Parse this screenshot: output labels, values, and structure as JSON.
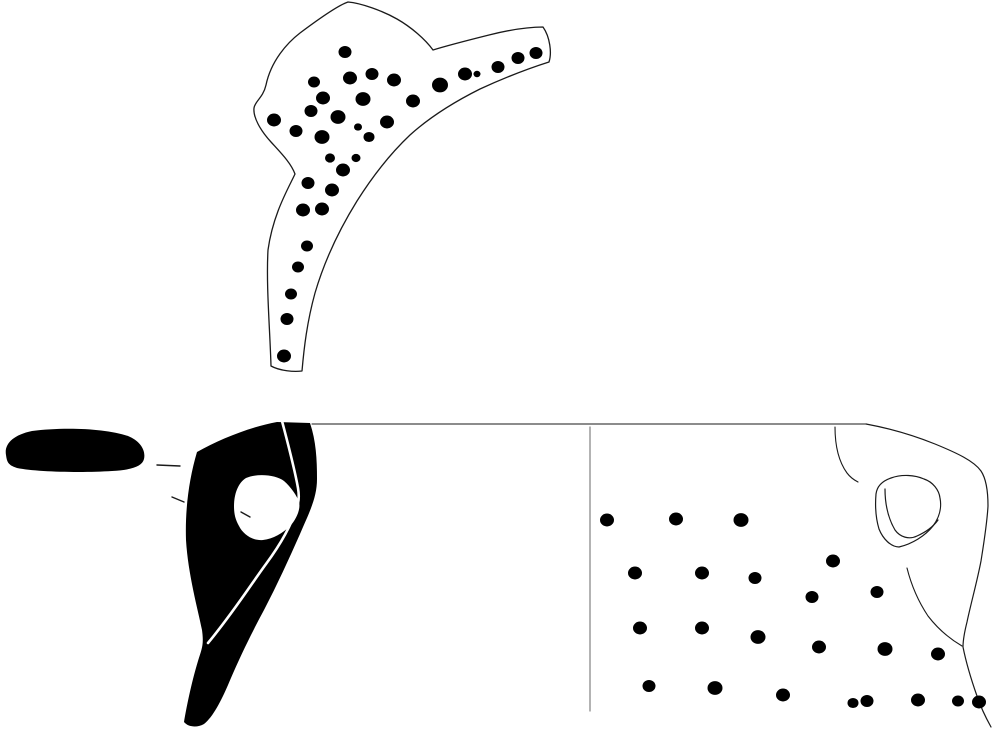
{
  "canvas": {
    "width": 995,
    "height": 730,
    "background_color": "#ffffff",
    "ink_color": "#000000",
    "outline_color": "#1a1a1a",
    "divider_color": "#8a8a8a"
  },
  "figures": {
    "top_sherd": {
      "elements": [
        {
          "kind": "path",
          "name": "top-sherd-outline",
          "d": "M348,2 C336,6 312,24 300,33 C287,43 271,61 266,85 C263,98 255,101 254,108 C253,117 260,130 271,142 C281,153 291,163 295,174 C288,189 273,214 268,250 C266,285 270,330 271,366 C280,371 294,372 302,371 C304,348 307,322 315,293 C325,259 339,230 357,201 C374,174 391,153 410,135 C431,116 456,101 480,89 C504,78 530,68 549,62 C552,53 550,37 543,27 C529,27 509,30 489,35 C469,40 449,45 433,50 C425,39 411,27 397,19 C383,11 361,3 348,2 Z",
          "fill": "#ffffff",
          "stroke": "#1a1a1a",
          "stroke_width": 1.3
        },
        {
          "kind": "dots",
          "name": "puncture-dot",
          "fill": "#000000",
          "points": [
            [
              345,
              52,
              6.5
            ],
            [
              314,
              82,
              6
            ],
            [
              350,
              78,
              7
            ],
            [
              372,
              74,
              6.5
            ],
            [
              394,
              80,
              7
            ],
            [
              440,
              85,
              8
            ],
            [
              465,
              74,
              7
            ],
            [
              477,
              74,
              3.5
            ],
            [
              498,
              67,
              6.5
            ],
            [
              518,
              58,
              6.5
            ],
            [
              536,
              53,
              6.5
            ],
            [
              323,
              98,
              7
            ],
            [
              363,
              99,
              7.5
            ],
            [
              413,
              101,
              7
            ],
            [
              274,
              120,
              7
            ],
            [
              311,
              111,
              6.5
            ],
            [
              338,
              117,
              7.5
            ],
            [
              387,
              122,
              7
            ],
            [
              296,
              131,
              6.5
            ],
            [
              358,
              127,
              4
            ],
            [
              322,
              137,
              7.5
            ],
            [
              369,
              137,
              5.5
            ],
            [
              330,
              158,
              5
            ],
            [
              356,
              158,
              4.5
            ],
            [
              343,
              170,
              7
            ],
            [
              308,
              183,
              6.5
            ],
            [
              332,
              190,
              7
            ],
            [
              303,
              210,
              7
            ],
            [
              322,
              209,
              7
            ],
            [
              307,
              246,
              6
            ],
            [
              298,
              267,
              6
            ],
            [
              291,
              294,
              6
            ],
            [
              287,
              319,
              6.5
            ],
            [
              284,
              356,
              7
            ]
          ]
        }
      ]
    },
    "handle_plan": {
      "elements": [
        {
          "kind": "path",
          "name": "handle-plan-silhouette",
          "d": "M6,455 C4,444 13,435 32,431 C62,427 104,428 128,436 C140,441 146,450 144,459 C142,467 130,470 112,471 C82,473 36,472 17,468 C8,465 7,462 6,455 Z",
          "fill": "#000000",
          "stroke": "none",
          "stroke_width": 0
        },
        {
          "kind": "line",
          "name": "measure-tick",
          "x1": 157,
          "y1": 465,
          "x2": 180,
          "y2": 466,
          "stroke": "#1a1a1a",
          "stroke_width": 1.4
        },
        {
          "kind": "line",
          "name": "measure-tick",
          "x1": 172,
          "y1": 497,
          "x2": 184,
          "y2": 502,
          "stroke": "#1a1a1a",
          "stroke_width": 1.4
        }
      ]
    },
    "handle_section": {
      "elements": [
        {
          "kind": "path",
          "name": "handle-section-silhouette",
          "d": "M197,452 C220,439 250,427 277,422 L310,423 C316,441 317,459 317,479 C317,498 309,513 300,534 C289,559 277,585 264,610 C251,634 238,661 228,685 C221,701 213,717 204,724 C197,728 188,727 184,722 C186,710 191,684 198,661 C202,648 204,645 202,630 C198,610 188,574 186,540 C185,509 189,479 197,452 Z",
          "fill": "#000000",
          "stroke": "none",
          "stroke_width": 0
        },
        {
          "kind": "path",
          "name": "handle-section-hole",
          "d": "M234,506 C234,494 238,483 246,478 C258,473 276,475 284,481 C291,487 297,496 299,502 C301,509 296,520 290,526 C283,533 273,539 263,540 C252,541 243,534 239,526 C235,519 234,513 234,506 Z",
          "fill": "#ffffff",
          "stroke": "none",
          "stroke_width": 0
        },
        {
          "kind": "path",
          "name": "handle-section-break-line",
          "d": "M282,421 C288,444 294,466 298,488 C299,494 299,499 298,503 C293,523 280,545 266,564 C252,583 233,613 208,643",
          "fill": "none",
          "stroke": "#ffffff",
          "stroke_width": 2.6
        },
        {
          "kind": "line",
          "name": "hole-tick",
          "x1": 241,
          "y1": 512,
          "x2": 250,
          "y2": 517,
          "stroke": "#1a1a1a",
          "stroke_width": 1.4
        }
      ]
    },
    "body_sherd": {
      "elements": [
        {
          "kind": "line",
          "name": "rim-line",
          "x1": 312,
          "y1": 424,
          "x2": 866,
          "y2": 424,
          "stroke": "#1a1a1a",
          "stroke_width": 1.1
        },
        {
          "kind": "line",
          "name": "section-divider-line",
          "x1": 590,
          "y1": 427,
          "x2": 590,
          "y2": 711,
          "stroke": "#8a8a8a",
          "stroke_width": 1.3
        },
        {
          "kind": "path",
          "name": "body-sherd-outline",
          "d": "M866,424 C893,429 915,436 935,444 C957,453 974,461 981,471 C987,480 988,494 988,506 C987,524 984,542 981,561 C977,582 971,603 967,622 C964,634 963,641 963,647 C966,662 971,679 977,696 C981,708 986,718 991,727",
          "fill": "none",
          "stroke": "#1a1a1a",
          "stroke_width": 1.2
        },
        {
          "kind": "path",
          "name": "break-edge-line",
          "d": "M907,568 C911,584 918,601 928,616 C938,629 950,639 962,646",
          "fill": "none",
          "stroke": "#1a1a1a",
          "stroke_width": 1.1
        },
        {
          "kind": "path",
          "name": "handle-attachment-curve",
          "d": "M835,427 C835,446 839,462 847,473 C850,477 854,480 858,482",
          "fill": "none",
          "stroke": "#1a1a1a",
          "stroke_width": 1.1
        },
        {
          "kind": "path",
          "name": "handle-scar-outer",
          "d": "M876,494 C877,486 882,481 891,478 C902,474 915,475 924,479 C933,482 939,490 940,498 C942,508 939,518 933,526 C925,536 912,544 899,547 C891,547 883,539 879,529 C876,519 875,506 876,494 Z",
          "fill": "none",
          "stroke": "#1a1a1a",
          "stroke_width": 1.2
        },
        {
          "kind": "path",
          "name": "handle-scar-inner",
          "d": "M885,489 C885,503 888,518 895,530 C900,537 909,540 917,536 C926,532 933,527 938,520",
          "fill": "none",
          "stroke": "#1a1a1a",
          "stroke_width": 1.2
        },
        {
          "kind": "dots",
          "name": "puncture-dot",
          "fill": "#000000",
          "points": [
            [
              607,
              520,
              7
            ],
            [
              676,
              519,
              7
            ],
            [
              741,
              520,
              7.5
            ],
            [
              635,
              573,
              7
            ],
            [
              702,
              573,
              7
            ],
            [
              755,
              578,
              6.5
            ],
            [
              833,
              561,
              7
            ],
            [
              812,
              597,
              6.5
            ],
            [
              877,
              592,
              6.5
            ],
            [
              640,
              628,
              7
            ],
            [
              702,
              628,
              7
            ],
            [
              758,
              637,
              7.5
            ],
            [
              819,
              647,
              7
            ],
            [
              885,
              649,
              7.5
            ],
            [
              938,
              654,
              7
            ],
            [
              649,
              686,
              6.5
            ],
            [
              715,
              688,
              7.5
            ],
            [
              783,
              695,
              7
            ],
            [
              853,
              703,
              5.5
            ],
            [
              867,
              701,
              6.5
            ],
            [
              918,
              700,
              7
            ],
            [
              958,
              701,
              6
            ],
            [
              979,
              702,
              7
            ]
          ]
        }
      ]
    }
  }
}
